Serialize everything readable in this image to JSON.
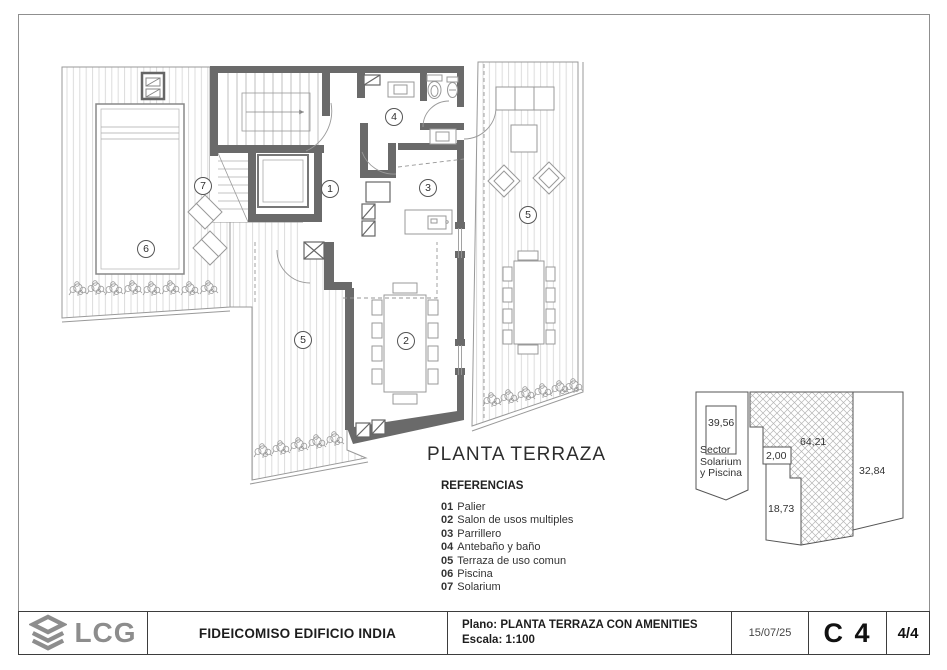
{
  "plan": {
    "title": "PLANTA TERRAZA",
    "references": {
      "title": "REFERENCIAS",
      "items": [
        {
          "num": "01",
          "label": "Palier"
        },
        {
          "num": "02",
          "label": "Salon de usos multiples"
        },
        {
          "num": "03",
          "label": "Parrillero"
        },
        {
          "num": "04",
          "label": "Antebaño y baño"
        },
        {
          "num": "05",
          "label": "Terraza de uso comun"
        },
        {
          "num": "06",
          "label": "Piscina"
        },
        {
          "num": "07",
          "label": "Solarium"
        }
      ]
    },
    "room_labels": {
      "r1": "1",
      "r2": "2",
      "r3": "3",
      "r4": "4",
      "r5a": "5",
      "r5b": "5",
      "r6": "6",
      "r7": "7"
    }
  },
  "key_plan": {
    "sector_line1": "Sector",
    "sector_line2": "Solarium",
    "sector_line3": "y Piscina",
    "area_39": "39,56",
    "area_2": "2,00",
    "area_64": "64,21",
    "area_32": "32,84",
    "area_18": "18,73"
  },
  "title_block": {
    "logo": "LCG",
    "project": "FIDEICOMISO EDIFICIO INDIA",
    "plano": "Plano: PLANTA TERRAZA CON AMENITIES",
    "escala": "Escala: 1:100",
    "date": "15/07/25",
    "code": "C 4",
    "page": "4/4"
  },
  "colors": {
    "wall": "#6a6a6a",
    "thin_line": "#999999",
    "deck_stripe": "#dcdcdc",
    "text": "#333333",
    "logo_gray": "#8d8d8d"
  }
}
